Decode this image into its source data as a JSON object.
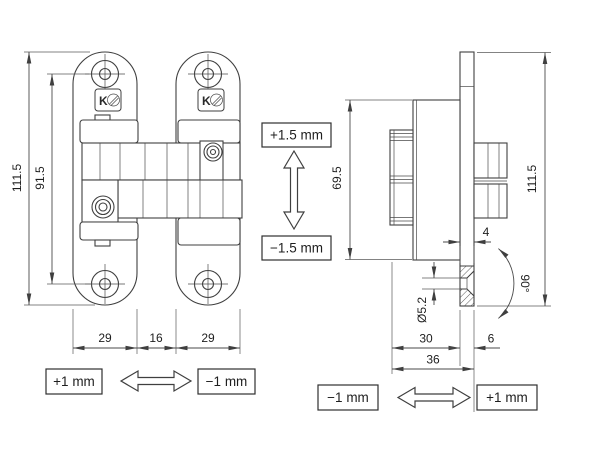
{
  "front_view": {
    "dim_total_height": "111.5",
    "dim_hole_spacing": "91.5",
    "dim_left_plate_width": "29",
    "dim_center_gap": "16",
    "dim_right_plate_width": "29",
    "adjust_plus": "+1 mm",
    "adjust_minus": "−1 mm"
  },
  "height_adjust": {
    "up_label": "+1.5 mm",
    "down_label": "−1.5 mm"
  },
  "side_view": {
    "dim_body_height": "69.5",
    "dim_total_height": "111.5",
    "dim_plate_offset": "4",
    "dim_hole_diameter": "Ø5.2",
    "dim_countersink_angle": "90°",
    "dim_body_depth": "30",
    "dim_flange_depth": "6",
    "dim_total_depth": "36",
    "adjust_minus": "−1 mm",
    "adjust_plus": "+1 mm"
  },
  "brand_logo": "K"
}
